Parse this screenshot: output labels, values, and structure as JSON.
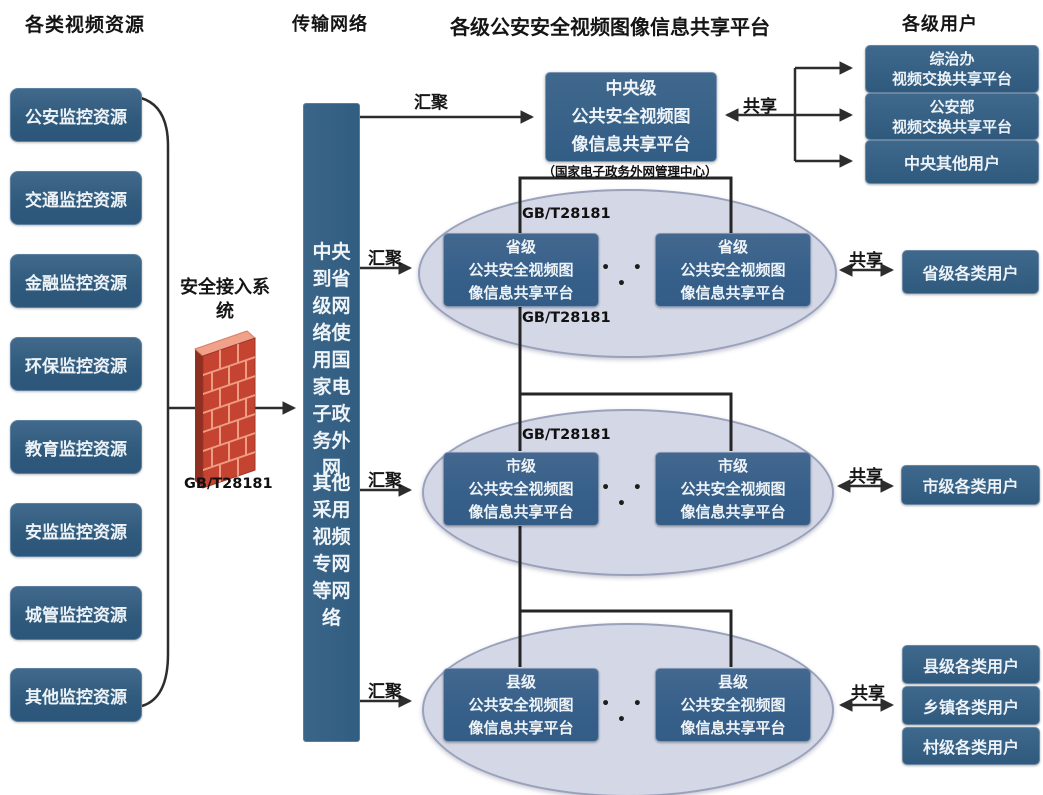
{
  "headers": {
    "resources": "各类视频资源",
    "transport": "传输网络",
    "platform": "各级公安安全视频图像信息共享平台",
    "users": "各级用户"
  },
  "resources": [
    "公安监控资源",
    "交通监控资源",
    "金融监控资源",
    "环保监控资源",
    "教育监控资源",
    "安监监控资源",
    "城管监控资源",
    "其他监控资源"
  ],
  "firewall": {
    "label": "安全接入系统",
    "standard": "GB/T28181"
  },
  "transport_box": {
    "upper": "中央到省级网络使用国家电子政务外网",
    "lower": "其他采用视频专网等网络"
  },
  "flow_labels": {
    "aggregate": "汇聚",
    "share": "共享"
  },
  "standard_label": "GB/T28181",
  "central": {
    "lines": [
      "中央级",
      "公共安全视频图",
      "像信息共享平台"
    ],
    "caption": "（国家电子政务外网管理中心）"
  },
  "levels": {
    "province": {
      "lines": [
        "省级",
        "公共安全视频图",
        "像信息共享平台"
      ],
      "dots": "• • •"
    },
    "city": {
      "lines": [
        "市级",
        "公共安全视频图",
        "像信息共享平台"
      ],
      "dots": "• • •"
    },
    "county": {
      "lines": [
        "县级",
        "公共安全视频图",
        "像信息共享平台"
      ],
      "dots": "• • •"
    }
  },
  "users": {
    "central": [
      [
        "综治办",
        "视频交换共享平台"
      ],
      [
        "公安部",
        "视频交换共享平台"
      ],
      [
        "中央其他用户"
      ]
    ],
    "province": "省级各类用户",
    "city": "市级各类用户",
    "county": [
      "县级各类用户",
      "乡镇各类用户",
      "村级各类用户"
    ]
  },
  "colors": {
    "platform_box": "#35608a",
    "resource_box": "#2f5a7c",
    "ellipse_fill": "#d4d7e5",
    "ellipse_border": "#9aa1bb",
    "connector": "#2d2d2d",
    "brick_front": "#c44431",
    "brick_top": "#f0a18a",
    "mortar": "#ef9c84",
    "text_on_box": "#ecf2f7"
  }
}
